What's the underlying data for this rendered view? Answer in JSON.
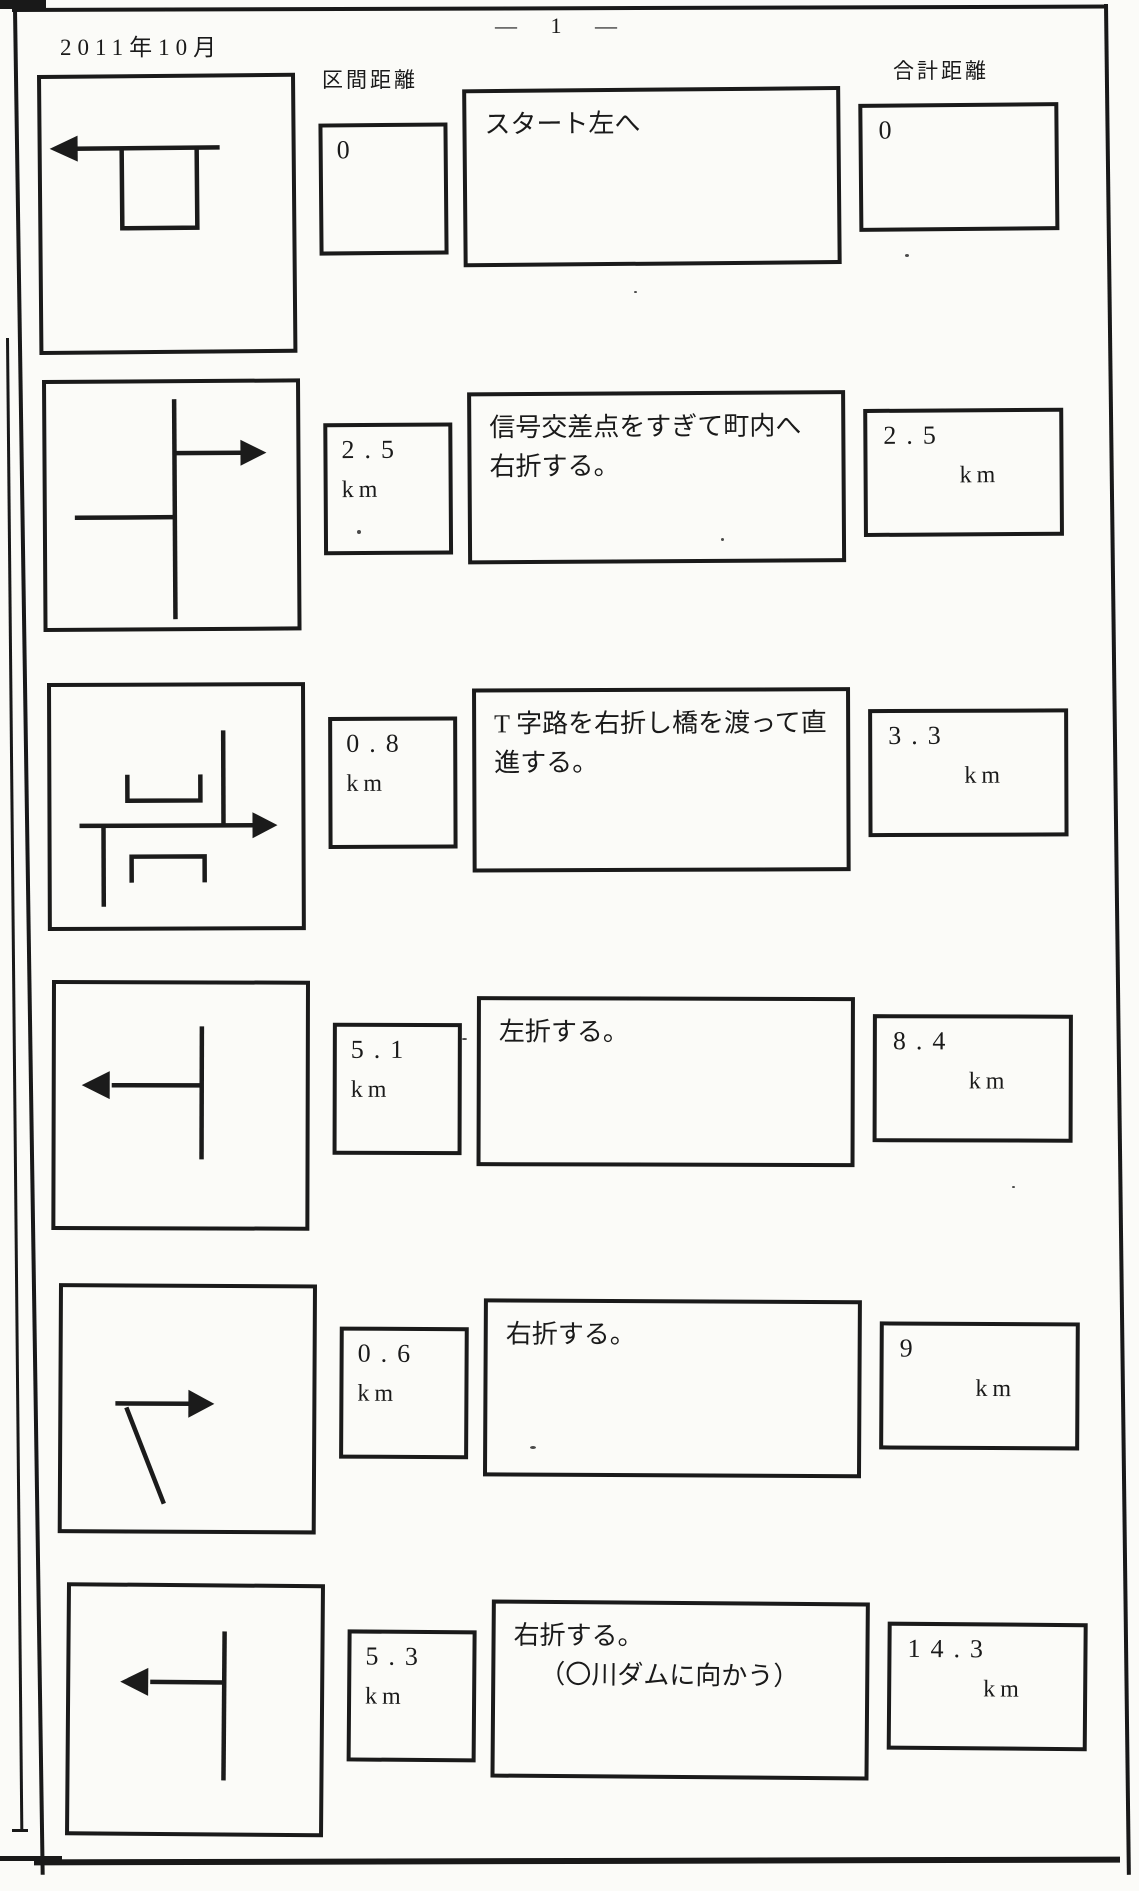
{
  "page": {
    "date": "2011年10月",
    "page_number": "— 1 —",
    "section_column_label": "区間距離",
    "total_column_label": "合計距離"
  },
  "rows": [
    {
      "diagram_icon": "start-box-route-arrow-left",
      "section_value": "0",
      "section_unit": "",
      "description": "スタート左へ",
      "description_line2": "",
      "total_value": "0",
      "total_unit": ""
    },
    {
      "diagram_icon": "crossroad-route-arrow-right",
      "section_value": "2.5",
      "section_unit": "km",
      "description": "信号交差点をすぎて町内へ右折する。",
      "description_line2": "",
      "total_value": "2.5",
      "total_unit": "km"
    },
    {
      "diagram_icon": "t-junction-bridge-route-arrow-right",
      "section_value": "0.8",
      "section_unit": "km",
      "description": "T 字路を右折し橋を渡って直進する。",
      "description_line2": "",
      "total_value": "3.3",
      "total_unit": "km"
    },
    {
      "diagram_icon": "t-junction-route-arrow-left",
      "section_value": "5.1",
      "section_unit": "km",
      "description": "左折する。",
      "description_line2": "",
      "total_value": "8.4",
      "total_unit": "km"
    },
    {
      "diagram_icon": "fork-route-arrow-right",
      "section_value": "0.6",
      "section_unit": "km",
      "description": "右折する。",
      "description_line2": "",
      "total_value": "9",
      "total_unit": "km"
    },
    {
      "diagram_icon": "t-junction-route-arrow-left",
      "section_value": "5.3",
      "section_unit": "km",
      "description": "右折する。",
      "description_line2": "（〇川ダムに向かう）",
      "total_value": "14.3",
      "total_unit": "km"
    }
  ]
}
